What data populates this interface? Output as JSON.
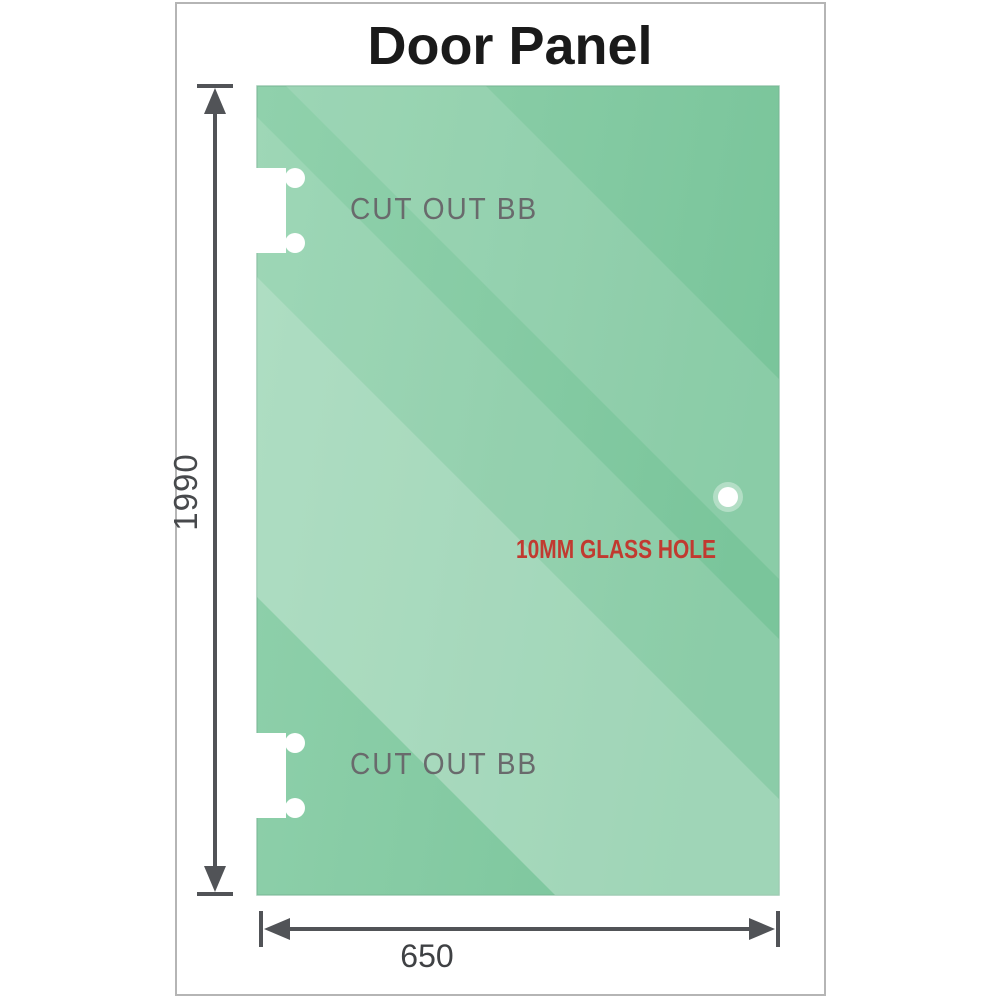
{
  "title": "Door Panel",
  "panel": {
    "glass_color": "#86cba4",
    "cutout_top_label": "CUT OUT BB",
    "cutout_bottom_label": "CUT OUT BB",
    "glass_hole_label": "10MM GLASS HOLE",
    "glass_hole_label_color": "#c13a30",
    "cutout_label_color": "#696a6c"
  },
  "dimensions": {
    "height_label": "1990",
    "width_label": "650"
  }
}
